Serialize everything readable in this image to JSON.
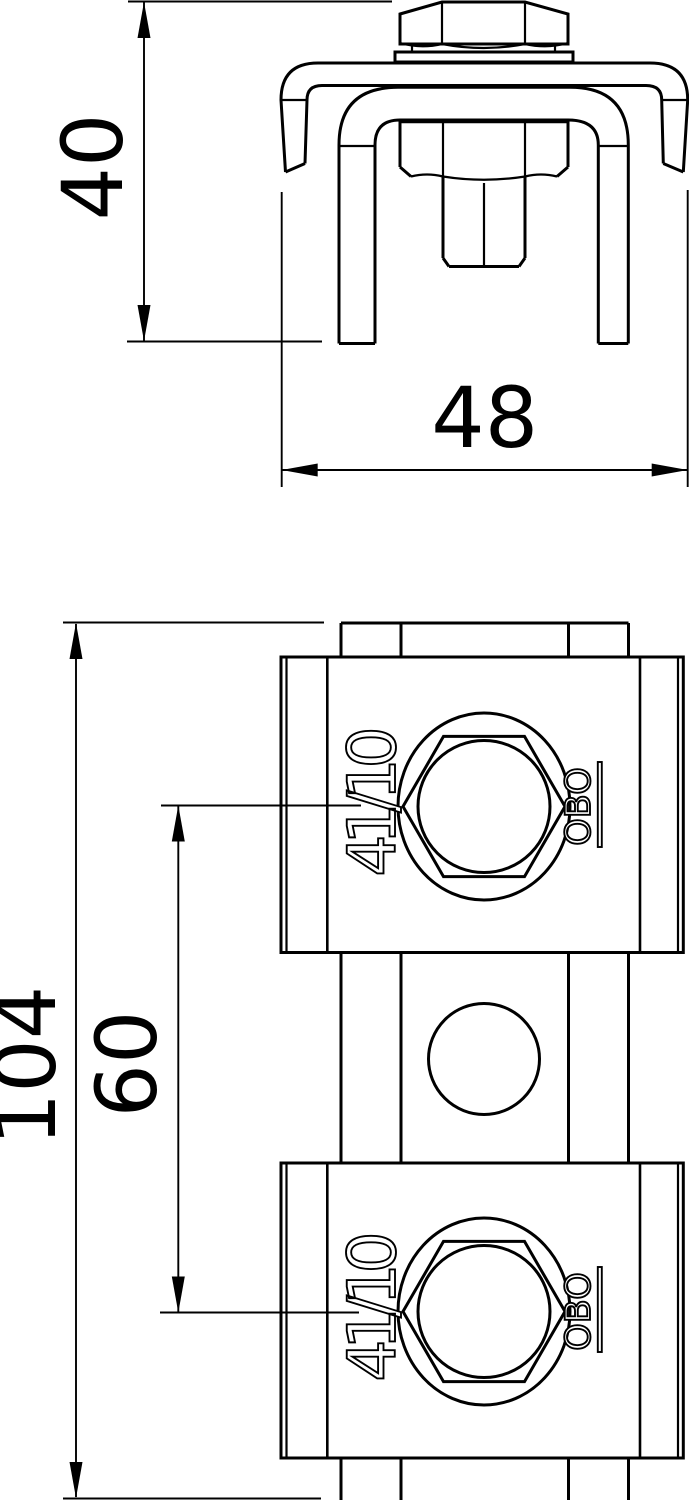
{
  "drawing": {
    "background": "#ffffff",
    "line_color": "#000000",
    "views": {
      "front_view": "clamp side elevation with hex bolt",
      "plan_view": "rail with two clamp blocks"
    }
  },
  "dims": {
    "front_height": "40",
    "front_width": "48",
    "plan_length": "104",
    "plan_spacing": "60"
  },
  "part": {
    "marking": "41/10",
    "brand": "OBO"
  }
}
